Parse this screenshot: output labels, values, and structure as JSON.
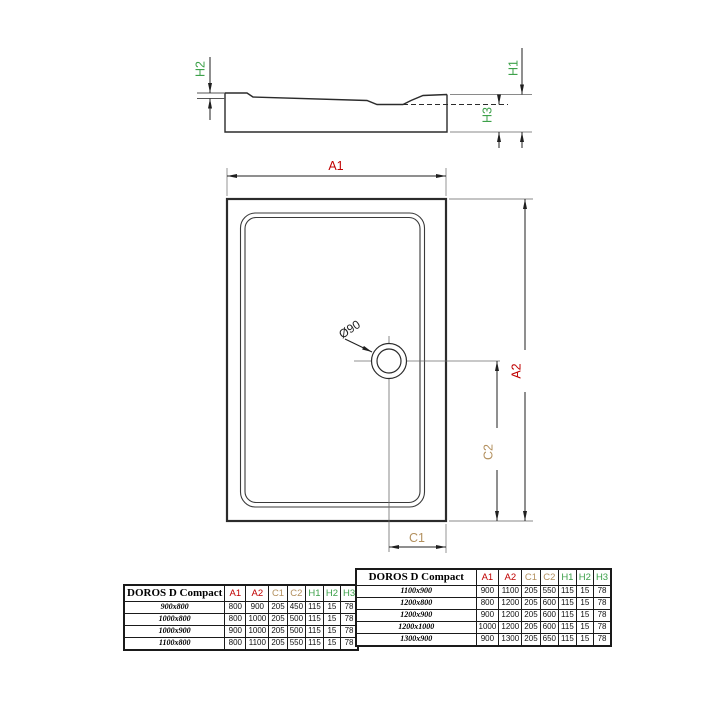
{
  "figure": {
    "product": "DOROS D Compact",
    "section_view": {
      "labels": {
        "h1": "H1",
        "h2": "H2",
        "h3": "H3"
      }
    },
    "plan_view": {
      "labels": {
        "a1": "A1",
        "a2": "A2",
        "c1": "C1",
        "c2": "C2",
        "drain_diameter": "Ø90"
      }
    },
    "colors": {
      "a_dim": "#c00000",
      "c_dim": "#b3905e",
      "h_dim": "#3da14a",
      "line": "#2b2b2b"
    }
  },
  "tables": {
    "columns": [
      "A1",
      "A2",
      "C1",
      "C2",
      "H1",
      "H2",
      "H3"
    ],
    "column_colors": [
      "#c00000",
      "#c00000",
      "#b3905e",
      "#b3905e",
      "#3da14a",
      "#3da14a",
      "#3da14a"
    ],
    "left": {
      "title": "DOROS D Compact",
      "rows": [
        {
          "model": "900x800",
          "values": [
            "800",
            "900",
            "205",
            "450",
            "115",
            "15",
            "78"
          ]
        },
        {
          "model": "1000x800",
          "values": [
            "800",
            "1000",
            "205",
            "500",
            "115",
            "15",
            "78"
          ]
        },
        {
          "model": "1000x900",
          "values": [
            "900",
            "1000",
            "205",
            "500",
            "115",
            "15",
            "78"
          ]
        },
        {
          "model": "1100x800",
          "values": [
            "800",
            "1100",
            "205",
            "550",
            "115",
            "15",
            "78"
          ]
        }
      ]
    },
    "right": {
      "title": "DOROS D Compact",
      "rows": [
        {
          "model": "1100x900",
          "values": [
            "900",
            "1100",
            "205",
            "550",
            "115",
            "15",
            "78"
          ]
        },
        {
          "model": "1200x800",
          "values": [
            "800",
            "1200",
            "205",
            "600",
            "115",
            "15",
            "78"
          ]
        },
        {
          "model": "1200x900",
          "values": [
            "900",
            "1200",
            "205",
            "600",
            "115",
            "15",
            "78"
          ]
        },
        {
          "model": "1200x1000",
          "values": [
            "1000",
            "1200",
            "205",
            "600",
            "115",
            "15",
            "78"
          ]
        },
        {
          "model": "1300x900",
          "values": [
            "900",
            "1300",
            "205",
            "650",
            "115",
            "15",
            "78"
          ]
        }
      ]
    }
  }
}
